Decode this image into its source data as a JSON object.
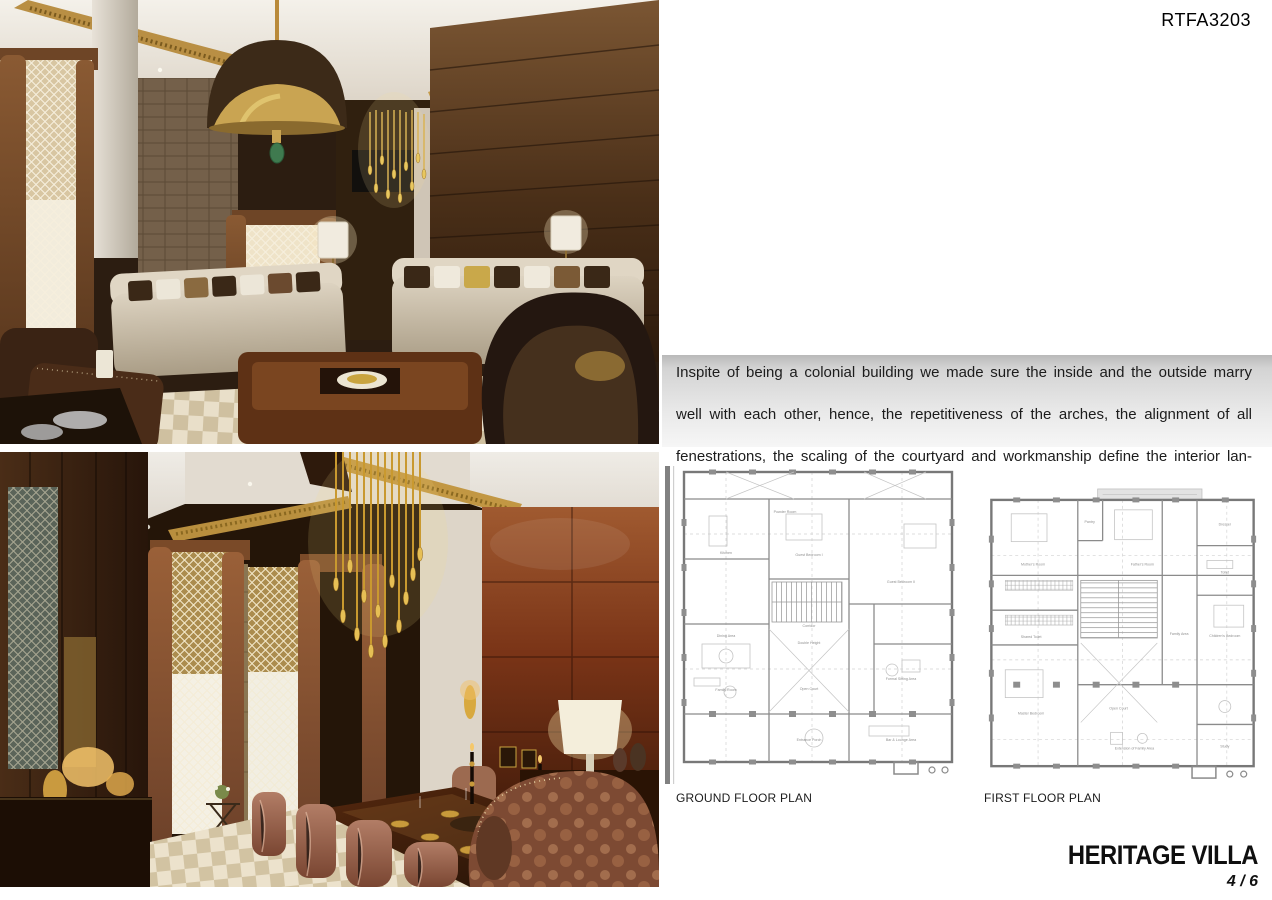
{
  "header": {
    "project_code": "RTFA3203"
  },
  "description": {
    "lines": [
      "Inspite of being a colonial building we made sure the inside and the outside marry",
      "well with each other, hence, the repetitiveness of the arches, the alignment of all",
      "fenestrations, the scaling of the courtyard and workmanship define the interior lan-",
      "guage throughout."
    ]
  },
  "plans": {
    "ground": {
      "label": "GROUND FLOOR PLAN",
      "rooms": [
        "Kitchen",
        "Powder Room",
        "Guest Bedroom I",
        "Guest Bedroom II",
        "Dining Area",
        "Corridor",
        "Double Height",
        "Open Court",
        "Family Room",
        "Formal Sitting Area",
        "Entrance Porch",
        "Bar & Lounge Area"
      ]
    },
    "first": {
      "label": "FIRST FLOOR PLAN",
      "rooms": [
        "Mother's Room",
        "Pantry",
        "Father's Room",
        "Dresser",
        "Toilet",
        "Shared Toilet",
        "Master Bedroom",
        "Open Court",
        "Family Area",
        "Children's Bedroom",
        "Extension of Family Area",
        "Study"
      ]
    }
  },
  "footer": {
    "title": "HERITAGE VILLA",
    "page_number": "4 / 6"
  },
  "colors": {
    "accent_gold": "#c39a4a",
    "band_gray_top": "#b9b9b9",
    "band_gray_bottom": "#f6f6f6",
    "title_black": "#0f0f0f"
  }
}
